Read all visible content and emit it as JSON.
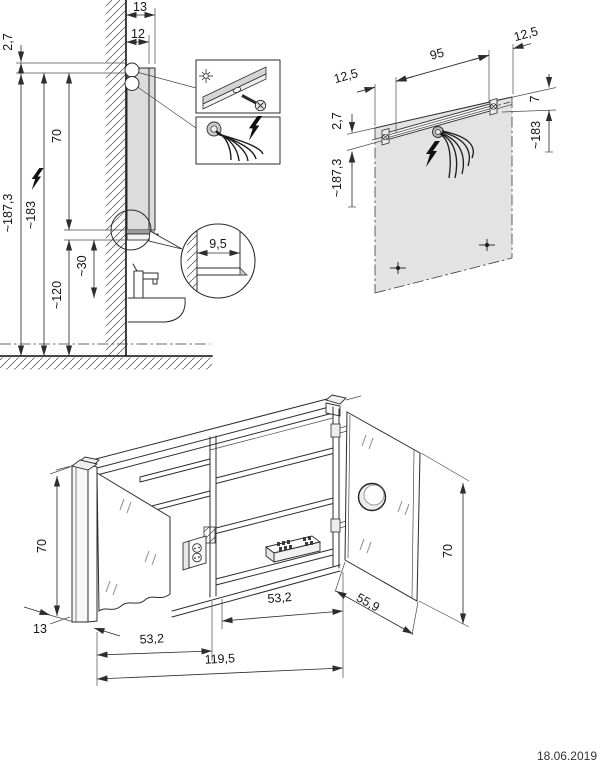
{
  "meta": {
    "date": "18.06.2019"
  },
  "figures": {
    "side_view": {
      "dims": {
        "top_depth": "13",
        "carcass_depth": "12",
        "top_offset": "2,7",
        "cabinet_height": "70",
        "total_height": "~187,3",
        "connection_height": "~183",
        "lower_height": "~120",
        "basin_gap": "~30",
        "recess_depth": "9,5"
      }
    },
    "wall_view": {
      "dims": {
        "offset_left": "12,5",
        "rail_width": "95",
        "offset_right": "12,5",
        "top_offset": "2,7",
        "total_height": "~187,3",
        "rail_drop": "7",
        "connection_height": "~183"
      }
    },
    "cabinet_view": {
      "dims": {
        "height_left": "70",
        "side_depth": "13",
        "left_door_width": "53,2",
        "right_door_width": "53,2",
        "total_width": "119,5",
        "door_diag_width": "55,9",
        "height_right": "70"
      }
    }
  }
}
